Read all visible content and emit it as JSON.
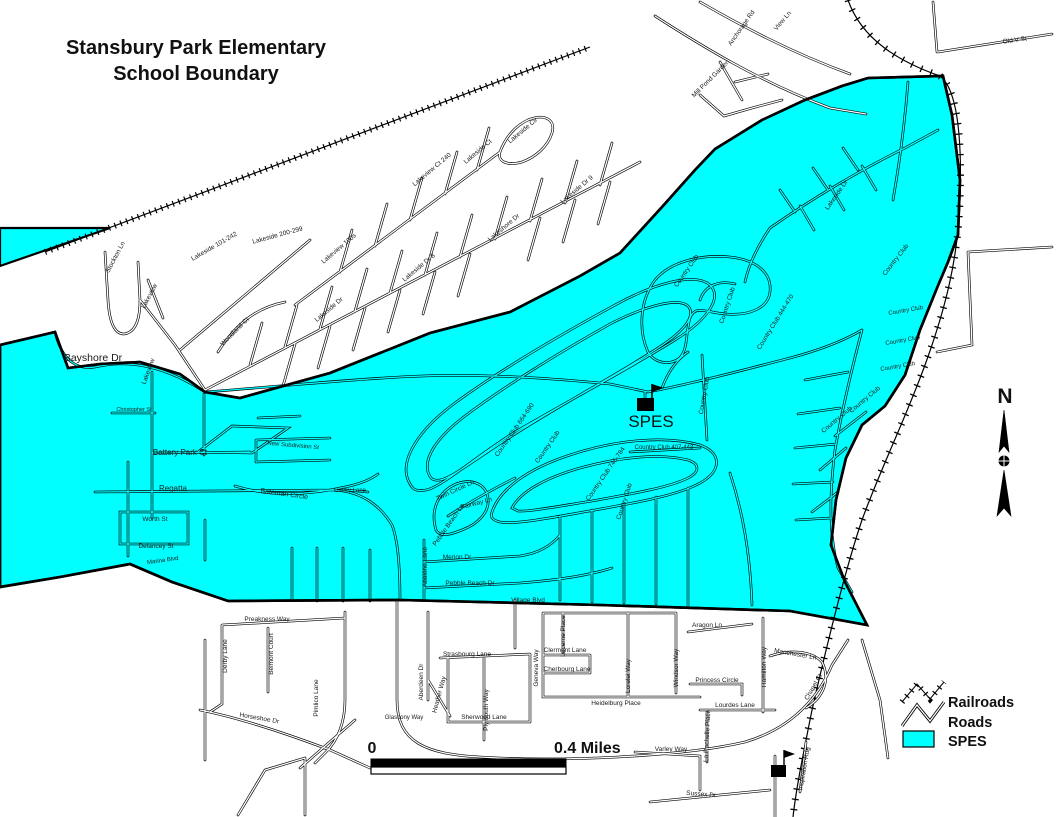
{
  "title": {
    "line1": "Stansbury Park Elementary",
    "line2": "School Boundary"
  },
  "colors": {
    "spes_fill": "#00ffff",
    "road_casing": "#000000",
    "background": "#ffffff"
  },
  "north_arrow": {
    "label": "N"
  },
  "scale_bar": {
    "start_label": "0",
    "end_label": "0.4 Miles"
  },
  "legend": {
    "items": [
      {
        "label": "Railroads",
        "symbol": "railroad-zigzag-icon"
      },
      {
        "label": "Roads",
        "symbol": "road-zigzag-icon"
      },
      {
        "label": "SPES",
        "symbol": "cyan-area-swatch"
      }
    ]
  },
  "school": {
    "label": "SPES",
    "marker": "flag-building-icon"
  },
  "map": {
    "street_labels": [
      {
        "name": "Bayshore Dr",
        "x": 93,
        "y": 361,
        "rot": 0,
        "size": 10.5
      },
      {
        "name": "Stockton Ln",
        "x": 117,
        "y": 258,
        "rot": -62,
        "size": 6.5
      },
      {
        "name": "Lakeview",
        "x": 151,
        "y": 297,
        "rot": -62,
        "size": 6.5
      },
      {
        "name": "Lakeside 101-242",
        "x": 215,
        "y": 248,
        "rot": -30,
        "size": 6.5
      },
      {
        "name": "Lakeside 200-299",
        "x": 278,
        "y": 237,
        "rot": -15,
        "size": 6.5
      },
      {
        "name": "Woodland Ct",
        "x": 236,
        "y": 333,
        "rot": -45,
        "size": 6.5
      },
      {
        "name": "Lakeview",
        "x": 150,
        "y": 372,
        "rot": -70,
        "size": 6.5
      },
      {
        "name": "Lakeview 100s",
        "x": 340,
        "y": 250,
        "rot": -40,
        "size": 6.5
      },
      {
        "name": "Lakeview Ct 240",
        "x": 433,
        "y": 171,
        "rot": -40,
        "size": 6.5
      },
      {
        "name": "Lakeside Ct",
        "x": 479,
        "y": 153,
        "rot": -40,
        "size": 6.5
      },
      {
        "name": "Lakeside Cir",
        "x": 524,
        "y": 132,
        "rot": -40,
        "size": 6.5
      },
      {
        "name": "Lakeside Dr",
        "x": 330,
        "y": 311,
        "rot": -40,
        "size": 6.5
      },
      {
        "name": "Lakeside Dr 8",
        "x": 420,
        "y": 269,
        "rot": -40,
        "size": 6.5
      },
      {
        "name": "Lakeshore Dr",
        "x": 505,
        "y": 229,
        "rot": -40,
        "size": 6.5
      },
      {
        "name": "Lakeside Dr 9",
        "x": 578,
        "y": 191,
        "rot": -40,
        "size": 6.5
      },
      {
        "name": "Lakeside Dr",
        "x": 838,
        "y": 196,
        "rot": -55,
        "size": 6.5
      },
      {
        "name": "Anchorage Rd",
        "x": 743,
        "y": 29,
        "rot": -55,
        "size": 6.5
      },
      {
        "name": "View Ln",
        "x": 784,
        "y": 22,
        "rot": -50,
        "size": 6.5
      },
      {
        "name": "Mill Pond Garden",
        "x": 712,
        "y": 80,
        "rot": -45,
        "size": 6.5
      },
      {
        "name": "Old V St",
        "x": 1015,
        "y": 42,
        "rot": -8,
        "size": 6.5
      },
      {
        "name": "Country Club",
        "x": 688,
        "y": 272,
        "rot": -55,
        "size": 6.5
      },
      {
        "name": "Country Club",
        "x": 729,
        "y": 306,
        "rot": -72,
        "size": 6.5
      },
      {
        "name": "Country Club 444-470",
        "x": 777,
        "y": 323,
        "rot": -58,
        "size": 6.5
      },
      {
        "name": "Country Club",
        "x": 897,
        "y": 261,
        "rot": -52,
        "size": 6.5
      },
      {
        "name": "Country Club",
        "x": 906,
        "y": 312,
        "rot": -10,
        "size": 6
      },
      {
        "name": "Country Club",
        "x": 903,
        "y": 342,
        "rot": -10,
        "size": 6
      },
      {
        "name": "Country Club",
        "x": 898,
        "y": 368,
        "rot": -10,
        "size": 6
      },
      {
        "name": "Country Club",
        "x": 866,
        "y": 401,
        "rot": -40,
        "size": 6.5
      },
      {
        "name": "Country Club",
        "x": 838,
        "y": 421,
        "rot": -40,
        "size": 6.5
      },
      {
        "name": "Country Club 664-690",
        "x": 516,
        "y": 431,
        "rot": -55,
        "size": 6.5
      },
      {
        "name": "Country Club",
        "x": 549,
        "y": 448,
        "rot": -55,
        "size": 6.5
      },
      {
        "name": "Country Club 746-784",
        "x": 607,
        "y": 475,
        "rot": -55,
        "size": 6.5
      },
      {
        "name": "Country Club",
        "x": 626,
        "y": 502,
        "rot": -72,
        "size": 6.5
      },
      {
        "name": "Country Club 407-443",
        "x": 664,
        "y": 449,
        "rot": 0,
        "size": 6
      },
      {
        "name": "Country Club",
        "x": 706,
        "y": 396,
        "rot": -80,
        "size": 6.5
      },
      {
        "name": "Twin Circle Ln",
        "x": 456,
        "y": 492,
        "rot": -25,
        "size": 6.5
      },
      {
        "name": "Fairway Ln",
        "x": 477,
        "y": 505,
        "rot": -15,
        "size": 6.5
      },
      {
        "name": "Pebble Beach Ln",
        "x": 450,
        "y": 526,
        "rot": -55,
        "size": 6.5
      },
      {
        "name": "Merion Dr",
        "x": 457,
        "y": 559,
        "rot": 0,
        "size": 6.5
      },
      {
        "name": "Pebble Beach Dr",
        "x": 470,
        "y": 585,
        "rot": 0,
        "size": 6.5
      },
      {
        "name": "Abalone Lane",
        "x": 427,
        "y": 567,
        "rot": -90,
        "size": 6.5
      },
      {
        "name": "Village Blvd",
        "x": 528,
        "y": 602,
        "rot": 0,
        "size": 6.5
      },
      {
        "name": "Marina Blvd",
        "x": 163,
        "y": 562,
        "rot": -8,
        "size": 6
      },
      {
        "name": "Battery Park Ct",
        "x": 180,
        "y": 455,
        "rot": 0,
        "size": 8
      },
      {
        "name": "Regatta",
        "x": 173,
        "y": 491,
        "rot": 0,
        "size": 8
      },
      {
        "name": "Worth St",
        "x": 155,
        "y": 521,
        "rot": 0,
        "size": 6.5
      },
      {
        "name": "Delancey St",
        "x": 156,
        "y": 548,
        "rot": 0,
        "size": 6.5
      },
      {
        "name": "Bateman Circle",
        "x": 284,
        "y": 496,
        "rot": 8,
        "size": 7
      },
      {
        "name": "New Subdivision St",
        "x": 293,
        "y": 447,
        "rot": 5,
        "size": 6
      },
      {
        "name": "Galley Lane",
        "x": 350,
        "y": 492,
        "rot": 0,
        "size": 6
      },
      {
        "name": "Christopher St",
        "x": 134,
        "y": 411,
        "rot": 0,
        "size": 5.5
      },
      {
        "name": "Preakness Way",
        "x": 267,
        "y": 621,
        "rot": 0,
        "size": 6.5
      },
      {
        "name": "Derby Lane",
        "x": 227,
        "y": 656,
        "rot": -90,
        "size": 6.5
      },
      {
        "name": "Belmont Court",
        "x": 273,
        "y": 654,
        "rot": -90,
        "size": 6.5
      },
      {
        "name": "Pimlico Lane",
        "x": 318,
        "y": 698,
        "rot": -90,
        "size": 6.5
      },
      {
        "name": "Horseshoe Dr",
        "x": 259,
        "y": 720,
        "rot": 10,
        "size": 6.5
      },
      {
        "name": "Glascony Way",
        "x": 404,
        "y": 719,
        "rot": 0,
        "size": 6
      },
      {
        "name": "Aberdeen Dr",
        "x": 423,
        "y": 682,
        "rot": -90,
        "size": 6.5
      },
      {
        "name": "Heather Way",
        "x": 441,
        "y": 695,
        "rot": -75,
        "size": 6.5
      },
      {
        "name": "Plymouth Way",
        "x": 488,
        "y": 710,
        "rot": -90,
        "size": 6.5
      },
      {
        "name": "Sherwood Lane",
        "x": 484,
        "y": 719,
        "rot": 0,
        "size": 6.5
      },
      {
        "name": "Strasbourg Lane",
        "x": 467,
        "y": 656,
        "rot": 0,
        "size": 6.5
      },
      {
        "name": "Clermont Lane",
        "x": 565,
        "y": 652,
        "rot": 0,
        "size": 6.5
      },
      {
        "name": "Cherbourg Lane",
        "x": 567,
        "y": 671,
        "rot": 0,
        "size": 6.5
      },
      {
        "name": "Geneva Way",
        "x": 538,
        "y": 668,
        "rot": -90,
        "size": 6.5
      },
      {
        "name": "Lucerne Place",
        "x": 565,
        "y": 636,
        "rot": -90,
        "size": 6.5
      },
      {
        "name": "Lorelei Way",
        "x": 630,
        "y": 676,
        "rot": -90,
        "size": 6.5
      },
      {
        "name": "Windsor Way",
        "x": 678,
        "y": 668,
        "rot": -90,
        "size": 6.5
      },
      {
        "name": "Heidelburg Place",
        "x": 616,
        "y": 705,
        "rot": 0,
        "size": 6.5
      },
      {
        "name": "Lourdes Lane",
        "x": 735,
        "y": 707,
        "rot": 0,
        "size": 6.5
      },
      {
        "name": "Princess Circle",
        "x": 717,
        "y": 682,
        "rot": 0,
        "size": 6.5
      },
      {
        "name": "Aragon Ln",
        "x": 707,
        "y": 627,
        "rot": 0,
        "size": 6.5
      },
      {
        "name": "Hamilton Way",
        "x": 766,
        "y": 667,
        "rot": -90,
        "size": 6.5
      },
      {
        "name": "Manchester Ln",
        "x": 795,
        "y": 656,
        "rot": 10,
        "size": 6.5
      },
      {
        "name": "Chapel Ct",
        "x": 815,
        "y": 688,
        "rot": -60,
        "size": 6.5
      },
      {
        "name": "La Rochelle Place",
        "x": 709,
        "y": 736,
        "rot": -87,
        "size": 6.5
      },
      {
        "name": "Varley Way",
        "x": 671,
        "y": 751,
        "rot": 0,
        "size": 6.5
      },
      {
        "name": "Sussex Dr",
        "x": 701,
        "y": 796,
        "rot": 5,
        "size": 6.5
      },
      {
        "name": "Inspiration Rdg",
        "x": 806,
        "y": 769,
        "rot": -80,
        "size": 6.5
      }
    ]
  }
}
